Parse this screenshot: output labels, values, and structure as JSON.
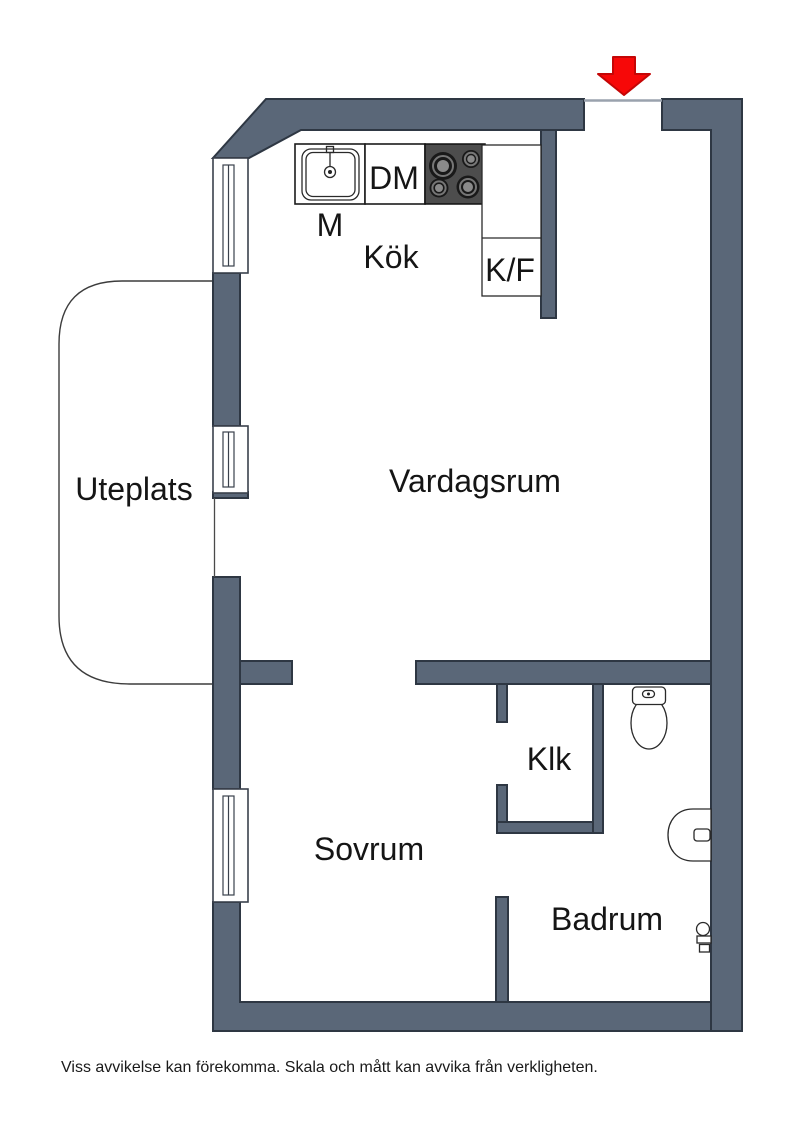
{
  "colors": {
    "wall": "#5a6778",
    "wall_outline": "#2e3743",
    "stove": "#4d4d4d",
    "arrow": "#f70808"
  },
  "rooms": {
    "kitchen": {
      "label": "Kök"
    },
    "living_room": {
      "label": "Vardagsrum"
    },
    "patio": {
      "label": "Uteplats"
    },
    "bedroom": {
      "label": "Sovrum"
    },
    "closet": {
      "label": "Klk"
    },
    "bathroom": {
      "label": "Badrum"
    }
  },
  "kitchen_fixtures": {
    "sink_label": "M",
    "dishwasher_label": "DM",
    "fridge_freezer_label": "K/F"
  },
  "entry": {
    "arrow_icon": "entry-direction-arrow"
  },
  "footer": {
    "disclaimer": "Viss avvikelse kan förekomma. Skala och mått kan avvika från verkligheten."
  }
}
